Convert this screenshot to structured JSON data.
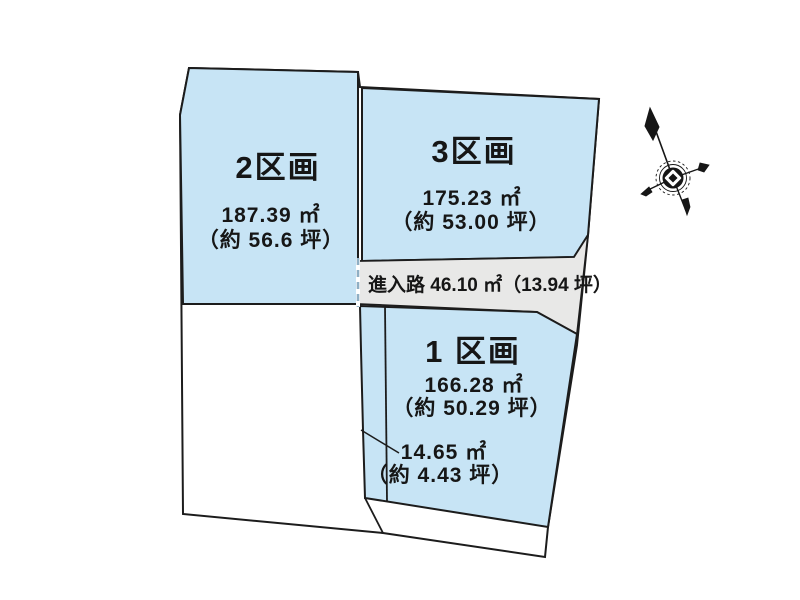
{
  "diagram": {
    "type": "land-plot-layout",
    "background": "#ffffff",
    "colors": {
      "lot_fill": "#c7e4f5",
      "road_fill": "#e8e8e7",
      "outline": "#1c1c1c",
      "dashed_boundary": "#8fafc4",
      "text": "#161616"
    },
    "lots": {
      "lot1": {
        "name": "1 区画",
        "area_m2": "166.28 ㎡",
        "area_tsubo": "（約 50.29 坪）"
      },
      "lot2": {
        "name": "2区画",
        "area_m2": "187.39 ㎡",
        "area_tsubo": "（約 56.6 坪）"
      },
      "lot3": {
        "name": "3区画",
        "area_m2": "175.23 ㎡",
        "area_tsubo": "（約 53.00 坪）"
      }
    },
    "access_road": {
      "label": "進入路 46.10 ㎡（13.94 坪）"
    },
    "lot1_sub_area": {
      "area_m2": "14.65 ㎡",
      "area_tsubo": "（約 4.43 坪）"
    },
    "compass": {
      "icon": "north-arrow"
    }
  }
}
